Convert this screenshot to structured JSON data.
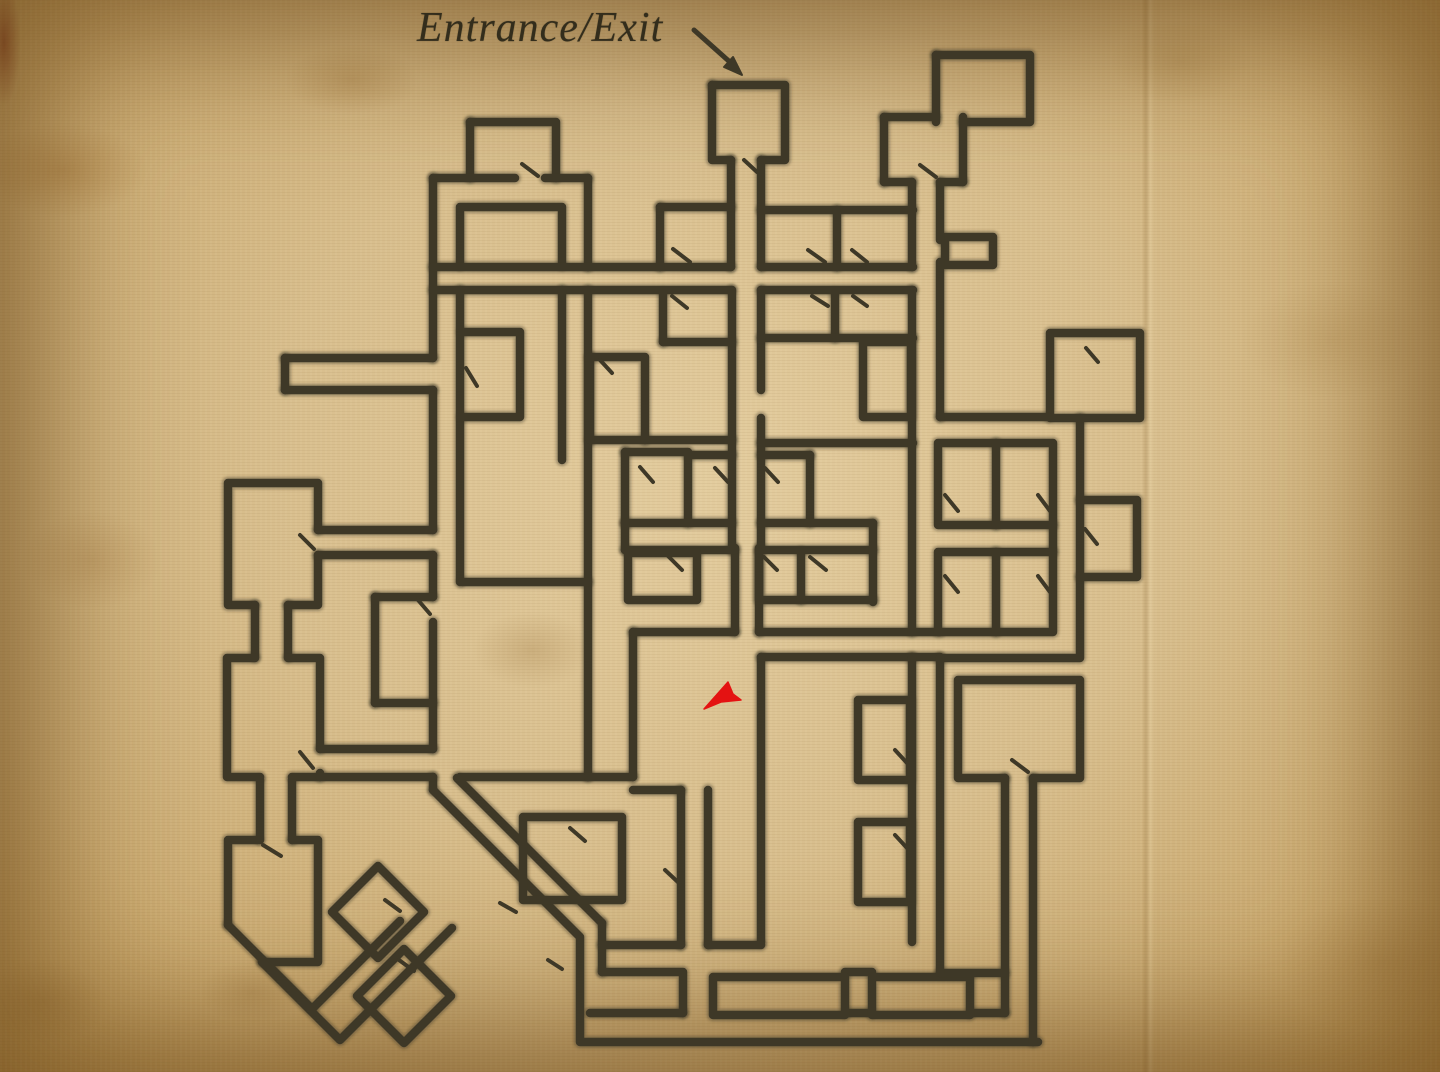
{
  "label": {
    "text": "Entrance/Exit"
  },
  "palette": {
    "parchment": "#d8be8d",
    "parchment_edge": "#b8914e",
    "wall_ink": "#3e3827",
    "wall_halo": "rgba(62,54,36,0.38)",
    "marker_red": "#e41212",
    "label_ink": "#332d1c"
  },
  "annotations": {
    "entrance_arrow": {
      "line": [
        694,
        30,
        731,
        63
      ],
      "head": "742,75 724,67 733,57"
    },
    "player_marker": {
      "x": 713,
      "y": 697,
      "points": "704,709 728,682 733,694 741,700 721,702"
    }
  },
  "maze": {
    "stroke_width": 8.5,
    "tick_width": 4,
    "walls": [
      "M712,85 H785 V160 H761",
      "M712,85 V160 H731",
      "M731,160 V267",
      "M761,160 V267",
      "M470,122 H556 V178",
      "M470,122 V178",
      "M433,178 H515",
      "M545,178 H588",
      "M433,178 V358",
      "M433,390 V530",
      "M433,555 V597",
      "M433,622 V749",
      "M433,777 V790",
      "M588,178 V267",
      "M588,290 V775",
      "M588,777 H460",
      "M457,778 L602,923",
      "M602,923 V972",
      "M433,790 L580,937 V1042 H1038",
      "M588,777 H633",
      "M633,790 H681",
      "M633,632 V777",
      "M633,632 H735",
      "M735,548 V632",
      "M759,548 V632",
      "M759,632 H940",
      "M460,265 V207 H562 V265",
      "M433,267 H731",
      "M761,267 H913",
      "M433,290 H731",
      "M761,290 H913",
      "M460,290 V582",
      "M462,582 H588",
      "M562,290 V460",
      "M462,332 H520 V417 H462",
      "M285,358 H433",
      "M285,390 H433",
      "M285,358 V390",
      "M318,530 H433",
      "M318,555 H433",
      "M375,597 H433",
      "M375,597 V703",
      "M375,703 H433",
      "M660,207 H731",
      "M660,207 V267",
      "M761,210 H913",
      "M837,210 V267",
      "M835,293 V338",
      "M761,338 H913",
      "M863,342 H911 V417 H863 V342",
      "M761,443 H913",
      "M761,290 V390",
      "M761,418 V550",
      "M732,290 V550",
      "M663,342 H732",
      "M663,293 V342",
      "M590,440 H732",
      "M590,357 H645 V440",
      "M590,357 V440",
      "M625,452 H688 V523",
      "M625,452 V523",
      "M688,455 H732",
      "M761,455 H810",
      "M810,455 V523",
      "M625,523 H732",
      "M761,523 H873",
      "M625,550 H735",
      "M759,550 H873",
      "M625,523 V550",
      "M873,523 V602",
      "M628,553 H697 V600 H628 V553",
      "M759,552 V600 H873",
      "M801,552 V600",
      "M761,657 H912",
      "M761,657 V942",
      "M858,700 H910 V780 H858 V700",
      "M858,822 H910 V902 H858 V822",
      "M681,790 V945",
      "M708,790 V945",
      "M523,817 H622 V900 H523 V817",
      "M602,945 H681",
      "M708,945 H761",
      "M602,972 H683 V1013",
      "M845,972 H872",
      "M590,1013 H683",
      "M845,1013 H872",
      "M970,1013 H1005",
      "M713,977 H845 V1015 H713 V977",
      "M872,977 H970 V1015 H872 V977",
      "M1005,778 V1013",
      "M1033,778 V1042",
      "M940,973 H1005",
      "M1005,778 H958 V680 H1080 V778 H1033",
      "M912,657 H940",
      "M940,658 H1080 V577",
      "M1080,500 H1137 V577 H1080 V500",
      "M1080,418 V500",
      "M1053,525 V552",
      "M1050,333 H1140 V418 H1050 V333",
      "M940,417 H1048",
      "M945,237 H993 V265 H945 V237",
      "M936,55 H1030 V122 H963",
      "M936,55 V122",
      "M884,117 H936",
      "M884,117 V182",
      "M963,117 V182",
      "M884,182 H912",
      "M940,182 H963",
      "M912,182 V267",
      "M912,290 V632",
      "M912,658 V942",
      "M940,182 V240",
      "M940,262 V417",
      "M940,658 V973",
      "M938,443 H1053 V525 H938 V443",
      "M996,443 V525",
      "M938,552 H1053 V632 H938 V552",
      "M996,552 V632",
      "M255,605 H228 V483 H318 V530",
      "M318,555 V605 H288",
      "M255,605 V657",
      "M288,605 V657",
      "M255,658 H227 V777 H260",
      "M292,777 H320 V773",
      "M320,749 V658 H288",
      "M320,749 H433",
      "M320,777 H433",
      "M260,780 V840",
      "M292,780 V840",
      "M228,925 V840 H258",
      "M292,840 H318 V962 H262",
      "M228,925 L312,1009 L400,921",
      "M262,962 L340,1040 L452,928",
      "M378,866 L424,912 L378,958 L332,912 Z",
      "M404,949 L451,996 L404,1043 L357,996 Z"
    ],
    "door_ticks": [
      [
        522,
        164,
        538,
        176
      ],
      [
        744,
        160,
        757,
        172
      ],
      [
        920,
        165,
        936,
        177
      ],
      [
        673,
        249,
        690,
        262
      ],
      [
        808,
        250,
        825,
        262
      ],
      [
        852,
        250,
        867,
        262
      ],
      [
        812,
        296,
        828,
        306
      ],
      [
        853,
        296,
        867,
        306
      ],
      [
        672,
        296,
        687,
        308
      ],
      [
        600,
        360,
        612,
        373
      ],
      [
        466,
        368,
        477,
        386
      ],
      [
        418,
        600,
        430,
        614
      ],
      [
        300,
        535,
        314,
        549
      ],
      [
        300,
        752,
        313,
        768
      ],
      [
        263,
        845,
        281,
        856
      ],
      [
        715,
        468,
        728,
        482
      ],
      [
        765,
        468,
        778,
        482
      ],
      [
        640,
        467,
        653,
        482
      ],
      [
        668,
        556,
        682,
        570
      ],
      [
        764,
        557,
        777,
        570
      ],
      [
        810,
        557,
        826,
        570
      ],
      [
        570,
        828,
        585,
        841
      ],
      [
        385,
        900,
        400,
        911
      ],
      [
        399,
        960,
        414,
        971
      ],
      [
        500,
        903,
        516,
        912
      ],
      [
        548,
        960,
        562,
        969
      ],
      [
        665,
        870,
        680,
        884
      ],
      [
        895,
        750,
        907,
        763
      ],
      [
        895,
        835,
        907,
        848
      ],
      [
        1012,
        760,
        1028,
        772
      ],
      [
        945,
        495,
        958,
        511
      ],
      [
        1038,
        495,
        1050,
        511
      ],
      [
        945,
        576,
        958,
        592
      ],
      [
        1038,
        576,
        1050,
        592
      ],
      [
        1085,
        529,
        1097,
        544
      ],
      [
        1086,
        348,
        1098,
        362
      ]
    ]
  }
}
